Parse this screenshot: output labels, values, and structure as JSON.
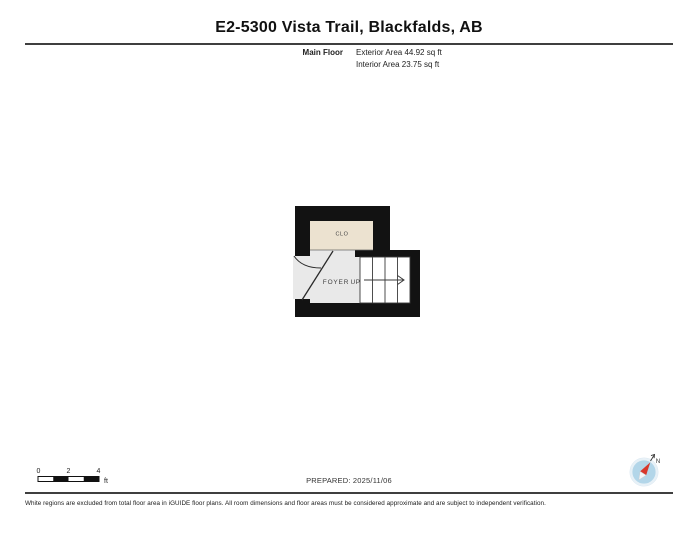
{
  "page": {
    "title": "E2-5300 Vista Trail, Blackfalds, AB"
  },
  "floor_info": {
    "floor_label": "Main Floor",
    "exterior_area": "Exterior Area 44.92 sq ft",
    "interior_area": "Interior Area 23.75 sq ft"
  },
  "floor_plan": {
    "labels": {
      "closet": "CLO",
      "foyer": "FOYER",
      "stairs_direction": "UP"
    },
    "colors": {
      "wall": "#121212",
      "closet_floor": "#ece2d0",
      "foyer_floor": "#e9e9e9",
      "stairs_floor": "#ffffff",
      "line": "#3a3a3a"
    }
  },
  "scale_bar": {
    "ticks": [
      "0",
      "2",
      "4"
    ],
    "unit": "ft"
  },
  "compass": {
    "north_label": "N",
    "disc_color": "#b3d6e9",
    "ring_color": "#e8f1f7",
    "needle_color": "#d8372b",
    "tail_color": "#f4f6f8"
  },
  "footer": {
    "prepared": "PREPARED: 2025/11/06",
    "disclaimer": "White regions are excluded from total floor area in iGUIDE floor plans. All room dimensions and floor areas must be considered approximate and are subject to independent verification."
  }
}
